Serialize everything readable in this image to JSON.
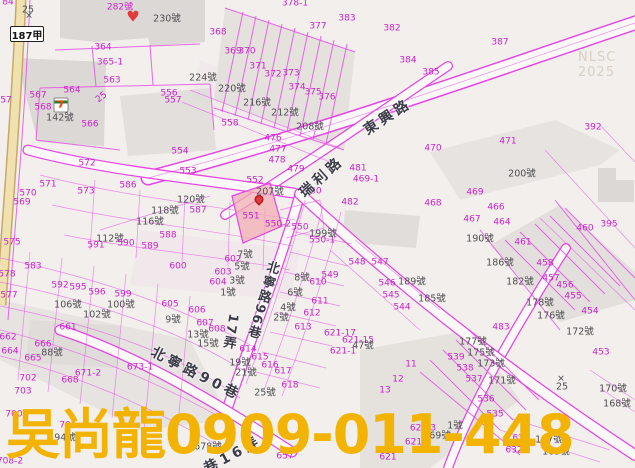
{
  "map": {
    "watermark": {
      "text": "吳尚龍0909-011-448"
    },
    "corner_watermark": {
      "text": "NLSC 2025"
    },
    "highway_shield": {
      "text": "187甲"
    },
    "colors": {
      "background": "#F2EFEC",
      "parcel_line": "#E645E6",
      "parcel_number": "#CC22CC",
      "address_text": "#4F4F52",
      "road_label": "#3C3C48",
      "road_fill": "#FBFAF8",
      "building_fill": "#DCD8D6",
      "highway_fill": "#F0E2B0",
      "highlight_parcel_fill": "#F1AEB4",
      "watermark_text": "#F3B303",
      "nlsc_watermark": "#D9CFC6",
      "marker_red": "#E23B3B"
    },
    "roads": [
      {
        "name": "東興路"
      },
      {
        "name": "瑞利路"
      },
      {
        "name": "北寧路96巷"
      },
      {
        "name": "北寧路90巷"
      },
      {
        "name": "巷16弄"
      },
      {
        "name": "17弄"
      },
      {
        "name": "187甲"
      }
    ],
    "labels": [
      {
        "t": "84",
        "x": 8,
        "y": 3,
        "ty": "p"
      },
      {
        "t": "25",
        "x": 28,
        "y": 10,
        "ty": "a"
      },
      {
        "x": 29,
        "y": 17,
        "ty": "mx",
        "t": "✕"
      },
      {
        "t": "282號",
        "x": 120,
        "y": 8,
        "ty": "p"
      },
      {
        "x": 133,
        "y": 17,
        "ty": "mh",
        "t": "♥"
      },
      {
        "t": "230號",
        "x": 167,
        "y": 19,
        "ty": "a"
      },
      {
        "t": "368",
        "x": 218,
        "y": 33,
        "ty": "p"
      },
      {
        "t": "369",
        "x": 233,
        "y": 52,
        "ty": "p"
      },
      {
        "t": "370",
        "x": 247,
        "y": 52,
        "ty": "p"
      },
      {
        "t": "371",
        "x": 258,
        "y": 67,
        "ty": "p"
      },
      {
        "t": "372",
        "x": 273,
        "y": 75,
        "ty": "p"
      },
      {
        "t": "373",
        "x": 291,
        "y": 74,
        "ty": "p"
      },
      {
        "t": "374",
        "x": 297,
        "y": 88,
        "ty": "p"
      },
      {
        "t": "375",
        "x": 313,
        "y": 93,
        "ty": "p"
      },
      {
        "t": "377",
        "x": 318,
        "y": 27,
        "ty": "p"
      },
      {
        "t": "378-1",
        "x": 295,
        "y": 4,
        "ty": "p"
      },
      {
        "t": "383",
        "x": 347,
        "y": 19,
        "ty": "p"
      },
      {
        "t": "382",
        "x": 392,
        "y": 29,
        "ty": "p"
      },
      {
        "t": "387",
        "x": 500,
        "y": 43,
        "ty": "p"
      },
      {
        "t": "384",
        "x": 408,
        "y": 61,
        "ty": "p"
      },
      {
        "t": "385",
        "x": 431,
        "y": 73,
        "ty": "p"
      },
      {
        "t": "376",
        "x": 327,
        "y": 98,
        "ty": "p"
      },
      {
        "t": "364",
        "x": 103,
        "y": 48,
        "ty": "p"
      },
      {
        "t": "365-1",
        "x": 110,
        "y": 63,
        "ty": "p"
      },
      {
        "t": "563",
        "x": 112,
        "y": 81,
        "ty": "p"
      },
      {
        "t": "564",
        "x": 72,
        "y": 91,
        "ty": "p"
      },
      {
        "t": "567",
        "x": 38,
        "y": 96,
        "ty": "p"
      },
      {
        "t": "568",
        "x": 43,
        "y": 108,
        "ty": "p"
      },
      {
        "t": "57",
        "x": 6,
        "y": 101,
        "ty": "p"
      },
      {
        "t": "25",
        "x": 102,
        "y": 98,
        "ty": "p",
        "r": -38
      },
      {
        "x": 61,
        "y": 105,
        "ty": "m7"
      },
      {
        "t": "142號",
        "x": 60,
        "y": 118,
        "ty": "a"
      },
      {
        "t": "566",
        "x": 90,
        "y": 125,
        "ty": "p"
      },
      {
        "t": "556",
        "x": 169,
        "y": 94,
        "ty": "p"
      },
      {
        "t": "557",
        "x": 173,
        "y": 101,
        "ty": "p"
      },
      {
        "t": "558",
        "x": 230,
        "y": 124,
        "ty": "p"
      },
      {
        "t": "224號",
        "x": 203,
        "y": 78,
        "ty": "a"
      },
      {
        "t": "220號",
        "x": 232,
        "y": 89,
        "ty": "a"
      },
      {
        "t": "216號",
        "x": 257,
        "y": 103,
        "ty": "a"
      },
      {
        "t": "212號",
        "x": 285,
        "y": 113,
        "ty": "a"
      },
      {
        "t": "208號",
        "x": 310,
        "y": 127,
        "ty": "a"
      },
      {
        "t": "476",
        "x": 273,
        "y": 139,
        "ty": "p"
      },
      {
        "t": "477",
        "x": 278,
        "y": 150,
        "ty": "p"
      },
      {
        "t": "478",
        "x": 277,
        "y": 161,
        "ty": "p"
      },
      {
        "t": "479",
        "x": 296,
        "y": 170,
        "ty": "p"
      },
      {
        "t": "480",
        "x": 313,
        "y": 192,
        "ty": "p"
      },
      {
        "t": "481",
        "x": 358,
        "y": 169,
        "ty": "p"
      },
      {
        "t": "469-1",
        "x": 366,
        "y": 180,
        "ty": "p"
      },
      {
        "t": "482",
        "x": 350,
        "y": 203,
        "ty": "p"
      },
      {
        "t": "468",
        "x": 433,
        "y": 204,
        "ty": "p"
      },
      {
        "t": "469",
        "x": 475,
        "y": 193,
        "ty": "p"
      },
      {
        "t": "467",
        "x": 472,
        "y": 220,
        "ty": "p"
      },
      {
        "t": "466",
        "x": 496,
        "y": 208,
        "ty": "p"
      },
      {
        "t": "464",
        "x": 502,
        "y": 223,
        "ty": "p"
      },
      {
        "t": "461",
        "x": 523,
        "y": 243,
        "ty": "p"
      },
      {
        "t": "460",
        "x": 585,
        "y": 229,
        "ty": "p"
      },
      {
        "t": "395",
        "x": 609,
        "y": 225,
        "ty": "p"
      },
      {
        "t": "392",
        "x": 593,
        "y": 128,
        "ty": "p"
      },
      {
        "t": "471",
        "x": 508,
        "y": 142,
        "ty": "p"
      },
      {
        "t": "470",
        "x": 433,
        "y": 149,
        "ty": "p"
      },
      {
        "t": "200號",
        "x": 522,
        "y": 174,
        "ty": "a"
      },
      {
        "t": "554",
        "x": 180,
        "y": 152,
        "ty": "p"
      },
      {
        "t": "553",
        "x": 188,
        "y": 172,
        "ty": "p"
      },
      {
        "t": "572",
        "x": 87,
        "y": 164,
        "ty": "p"
      },
      {
        "t": "571",
        "x": 48,
        "y": 185,
        "ty": "p"
      },
      {
        "t": "573",
        "x": 86,
        "y": 192,
        "ty": "p"
      },
      {
        "t": "570",
        "x": 28,
        "y": 194,
        "ty": "p"
      },
      {
        "t": "569",
        "x": 22,
        "y": 203,
        "ty": "p"
      },
      {
        "t": "586",
        "x": 128,
        "y": 186,
        "ty": "p"
      },
      {
        "t": "552",
        "x": 255,
        "y": 181,
        "ty": "p"
      },
      {
        "t": "207號",
        "x": 270,
        "y": 192,
        "ty": "a"
      },
      {
        "x": 259,
        "y": 203,
        "ty": "mp"
      },
      {
        "t": "551",
        "x": 251,
        "y": 217,
        "ty": "p"
      },
      {
        "t": "550-2",
        "x": 278,
        "y": 225,
        "ty": "p"
      },
      {
        "t": "550",
        "x": 300,
        "y": 228,
        "ty": "p"
      },
      {
        "t": "550-1",
        "x": 322,
        "y": 241,
        "ty": "p"
      },
      {
        "t": "199號",
        "x": 323,
        "y": 234,
        "ty": "a"
      },
      {
        "t": "120號",
        "x": 191,
        "y": 200,
        "ty": "a"
      },
      {
        "t": "118號",
        "x": 165,
        "y": 211,
        "ty": "a"
      },
      {
        "t": "116號",
        "x": 150,
        "y": 222,
        "ty": "a"
      },
      {
        "t": "112號",
        "x": 110,
        "y": 239,
        "ty": "a"
      },
      {
        "t": "587",
        "x": 198,
        "y": 211,
        "ty": "p"
      },
      {
        "t": "588",
        "x": 168,
        "y": 236,
        "ty": "p"
      },
      {
        "t": "589",
        "x": 150,
        "y": 247,
        "ty": "p"
      },
      {
        "t": "590",
        "x": 126,
        "y": 244,
        "ty": "p"
      },
      {
        "t": "591",
        "x": 96,
        "y": 246,
        "ty": "p"
      },
      {
        "t": "575",
        "x": 12,
        "y": 243,
        "ty": "p"
      },
      {
        "t": "578",
        "x": 7,
        "y": 275,
        "ty": "p"
      },
      {
        "t": "577",
        "x": 9,
        "y": 296,
        "ty": "p"
      },
      {
        "t": "583",
        "x": 33,
        "y": 267,
        "ty": "p"
      },
      {
        "t": "592",
        "x": 60,
        "y": 286,
        "ty": "p"
      },
      {
        "t": "595",
        "x": 78,
        "y": 288,
        "ty": "p"
      },
      {
        "t": "596",
        "x": 97,
        "y": 293,
        "ty": "p"
      },
      {
        "t": "599",
        "x": 123,
        "y": 295,
        "ty": "p"
      },
      {
        "t": "600",
        "x": 178,
        "y": 267,
        "ty": "p"
      },
      {
        "t": "106號",
        "x": 68,
        "y": 305,
        "ty": "a"
      },
      {
        "t": "100號",
        "x": 121,
        "y": 305,
        "ty": "a"
      },
      {
        "t": "102號",
        "x": 97,
        "y": 315,
        "ty": "a"
      },
      {
        "t": "602",
        "x": 233,
        "y": 260,
        "ty": "p"
      },
      {
        "t": "603",
        "x": 223,
        "y": 273,
        "ty": "p"
      },
      {
        "t": "604",
        "x": 218,
        "y": 283,
        "ty": "p"
      },
      {
        "t": "605",
        "x": 170,
        "y": 305,
        "ty": "p"
      },
      {
        "t": "606",
        "x": 197,
        "y": 311,
        "ty": "p"
      },
      {
        "t": "607",
        "x": 205,
        "y": 324,
        "ty": "p"
      },
      {
        "t": "608",
        "x": 217,
        "y": 330,
        "ty": "p"
      },
      {
        "t": "7號",
        "x": 245,
        "y": 255,
        "ty": "a"
      },
      {
        "t": "5號",
        "x": 242,
        "y": 267,
        "ty": "a"
      },
      {
        "t": "3號",
        "x": 237,
        "y": 281,
        "ty": "a"
      },
      {
        "t": "1號",
        "x": 228,
        "y": 293,
        "ty": "a"
      },
      {
        "t": "8號",
        "x": 302,
        "y": 278,
        "ty": "a"
      },
      {
        "t": "6號",
        "x": 295,
        "y": 293,
        "ty": "a"
      },
      {
        "t": "4號",
        "x": 288,
        "y": 308,
        "ty": "a"
      },
      {
        "t": "2號",
        "x": 281,
        "y": 318,
        "ty": "a"
      },
      {
        "t": "9號",
        "x": 173,
        "y": 320,
        "ty": "a"
      },
      {
        "t": "13號",
        "x": 198,
        "y": 335,
        "ty": "a"
      },
      {
        "t": "15號",
        "x": 208,
        "y": 344,
        "ty": "a"
      },
      {
        "t": "19號",
        "x": 240,
        "y": 363,
        "ty": "a"
      },
      {
        "t": "21號",
        "x": 246,
        "y": 373,
        "ty": "a"
      },
      {
        "t": "25號",
        "x": 265,
        "y": 393,
        "ty": "a"
      },
      {
        "t": "610",
        "x": 318,
        "y": 283,
        "ty": "p"
      },
      {
        "t": "611",
        "x": 320,
        "y": 302,
        "ty": "p"
      },
      {
        "t": "612",
        "x": 312,
        "y": 314,
        "ty": "p"
      },
      {
        "t": "613",
        "x": 303,
        "y": 328,
        "ty": "p"
      },
      {
        "t": "614",
        "x": 248,
        "y": 350,
        "ty": "p"
      },
      {
        "t": "615",
        "x": 260,
        "y": 358,
        "ty": "p"
      },
      {
        "t": "616",
        "x": 270,
        "y": 366,
        "ty": "p"
      },
      {
        "t": "617",
        "x": 283,
        "y": 372,
        "ty": "p"
      },
      {
        "t": "618",
        "x": 290,
        "y": 386,
        "ty": "p"
      },
      {
        "t": "549",
        "x": 330,
        "y": 276,
        "ty": "p"
      },
      {
        "t": "548",
        "x": 357,
        "y": 263,
        "ty": "p"
      },
      {
        "t": "547",
        "x": 380,
        "y": 263,
        "ty": "p"
      },
      {
        "t": "546",
        "x": 387,
        "y": 284,
        "ty": "p"
      },
      {
        "t": "545",
        "x": 391,
        "y": 296,
        "ty": "p"
      },
      {
        "t": "544",
        "x": 402,
        "y": 308,
        "ty": "p"
      },
      {
        "t": "621-17",
        "x": 340,
        "y": 334,
        "ty": "p"
      },
      {
        "t": "621-15",
        "x": 358,
        "y": 341,
        "ty": "p"
      },
      {
        "t": "47號",
        "x": 363,
        "y": 346,
        "ty": "a"
      },
      {
        "t": "621-1",
        "x": 343,
        "y": 352,
        "ty": "p"
      },
      {
        "t": "190號",
        "x": 480,
        "y": 239,
        "ty": "a"
      },
      {
        "t": "186號",
        "x": 500,
        "y": 263,
        "ty": "a"
      },
      {
        "t": "182號",
        "x": 520,
        "y": 282,
        "ty": "a"
      },
      {
        "t": "189號",
        "x": 412,
        "y": 282,
        "ty": "a"
      },
      {
        "t": "185號",
        "x": 432,
        "y": 299,
        "ty": "a"
      },
      {
        "t": "178號",
        "x": 540,
        "y": 303,
        "ty": "a"
      },
      {
        "t": "176號",
        "x": 551,
        "y": 316,
        "ty": "a"
      },
      {
        "t": "172號",
        "x": 580,
        "y": 332,
        "ty": "a"
      },
      {
        "t": "458",
        "x": 545,
        "y": 264,
        "ty": "p"
      },
      {
        "t": "457",
        "x": 551,
        "y": 279,
        "ty": "p"
      },
      {
        "t": "456",
        "x": 565,
        "y": 286,
        "ty": "p"
      },
      {
        "t": "455",
        "x": 573,
        "y": 297,
        "ty": "p"
      },
      {
        "t": "454",
        "x": 590,
        "y": 312,
        "ty": "p"
      },
      {
        "t": "453",
        "x": 601,
        "y": 353,
        "ty": "p"
      },
      {
        "t": "483",
        "x": 501,
        "y": 328,
        "ty": "p"
      },
      {
        "t": "661",
        "x": 68,
        "y": 328,
        "ty": "p"
      },
      {
        "t": "662",
        "x": 8,
        "y": 338,
        "ty": "p"
      },
      {
        "t": "664",
        "x": 10,
        "y": 352,
        "ty": "p"
      },
      {
        "t": "666",
        "x": 43,
        "y": 345,
        "ty": "p"
      },
      {
        "t": "665",
        "x": 33,
        "y": 359,
        "ty": "p"
      },
      {
        "t": "88號",
        "x": 52,
        "y": 353,
        "ty": "a"
      },
      {
        "t": "671-2",
        "x": 88,
        "y": 374,
        "ty": "p"
      },
      {
        "t": "668",
        "x": 70,
        "y": 381,
        "ty": "p"
      },
      {
        "t": "673-1",
        "x": 140,
        "y": 368,
        "ty": "p"
      },
      {
        "t": "702",
        "x": 28,
        "y": 379,
        "ty": "p"
      },
      {
        "t": "703",
        "x": 23,
        "y": 392,
        "ty": "p"
      },
      {
        "t": "700",
        "x": 14,
        "y": 415,
        "ty": "p"
      },
      {
        "t": "701",
        "x": 68,
        "y": 426,
        "ty": "p"
      },
      {
        "t": "708-2",
        "x": 10,
        "y": 462,
        "ty": "p"
      },
      {
        "t": "94號",
        "x": 65,
        "y": 438,
        "ty": "a"
      },
      {
        "t": "11",
        "x": 411,
        "y": 365,
        "ty": "p"
      },
      {
        "t": "12",
        "x": 398,
        "y": 380,
        "ty": "p"
      },
      {
        "t": "13",
        "x": 385,
        "y": 391,
        "ty": "p"
      },
      {
        "t": "539",
        "x": 456,
        "y": 358,
        "ty": "p"
      },
      {
        "t": "538",
        "x": 465,
        "y": 369,
        "ty": "p"
      },
      {
        "t": "537",
        "x": 474,
        "y": 380,
        "ty": "p"
      },
      {
        "t": "536",
        "x": 486,
        "y": 400,
        "ty": "p"
      },
      {
        "t": "535",
        "x": 495,
        "y": 415,
        "ty": "p"
      },
      {
        "t": "177號",
        "x": 473,
        "y": 342,
        "ty": "a"
      },
      {
        "t": "175號",
        "x": 481,
        "y": 353,
        "ty": "a"
      },
      {
        "t": "173號",
        "x": 491,
        "y": 364,
        "ty": "a"
      },
      {
        "t": "171號",
        "x": 502,
        "y": 381,
        "ty": "a"
      },
      {
        "x": 561,
        "y": 380,
        "ty": "mx",
        "t": "✕"
      },
      {
        "t": "25",
        "x": 562,
        "y": 387,
        "ty": "a"
      },
      {
        "t": "170號",
        "x": 613,
        "y": 389,
        "ty": "a"
      },
      {
        "t": "168號",
        "x": 617,
        "y": 404,
        "ty": "a"
      },
      {
        "t": "634",
        "x": 521,
        "y": 439,
        "ty": "p"
      },
      {
        "t": "167號",
        "x": 549,
        "y": 440,
        "ty": "a"
      },
      {
        "t": "632",
        "x": 514,
        "y": 451,
        "ty": "p"
      },
      {
        "t": "165號",
        "x": 556,
        "y": 452,
        "ty": "a"
      },
      {
        "t": "621-3",
        "x": 423,
        "y": 429,
        "ty": "p"
      },
      {
        "t": "69號",
        "x": 440,
        "y": 436,
        "ty": "a"
      },
      {
        "t": "1號",
        "x": 455,
        "y": 426,
        "ty": "a"
      },
      {
        "t": "621-6",
        "x": 418,
        "y": 443,
        "ty": "p"
      },
      {
        "t": "621",
        "x": 388,
        "y": 458,
        "ty": "p"
      },
      {
        "t": "657",
        "x": 285,
        "y": 457,
        "ty": "p"
      },
      {
        "t": "678號",
        "x": 208,
        "y": 447,
        "ty": "a"
      },
      {
        "t": "東興路",
        "x": 388,
        "y": 117,
        "ty": "r",
        "r": -33
      },
      {
        "t": "瑞利路",
        "x": 322,
        "y": 177,
        "ty": "r",
        "r": -42
      },
      {
        "t": "北寧路96巷",
        "x": 262,
        "y": 300,
        "ty": "rv",
        "r": 16
      },
      {
        "t": "17弄",
        "x": 230,
        "y": 332,
        "ty": "rv",
        "r": 10
      },
      {
        "t": "北寧路90巷",
        "x": 196,
        "y": 374,
        "ty": "r",
        "r": 27
      },
      {
        "t": "巷16弄",
        "x": 233,
        "y": 455,
        "ty": "r",
        "r": -28
      }
    ]
  }
}
